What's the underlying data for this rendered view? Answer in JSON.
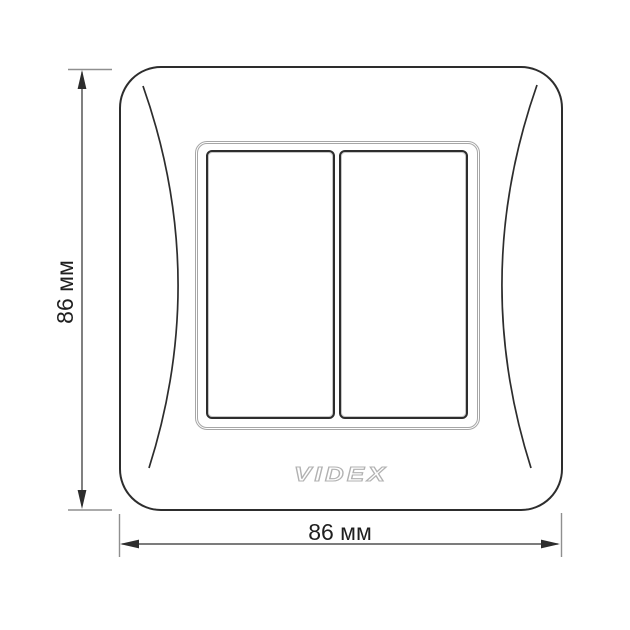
{
  "brand": {
    "logo_text": "VIDEX"
  },
  "dimensions": {
    "height_label": "86 мм",
    "width_label": "86 мм"
  },
  "colors": {
    "bg": "#ffffff",
    "line-dark": "#2d2d2d",
    "line-gray": "#a6a6a6",
    "tick-gray": "#8f8f8f",
    "label-ink": "#1f1f1f",
    "logo-gray": "#b2b2b2"
  }
}
